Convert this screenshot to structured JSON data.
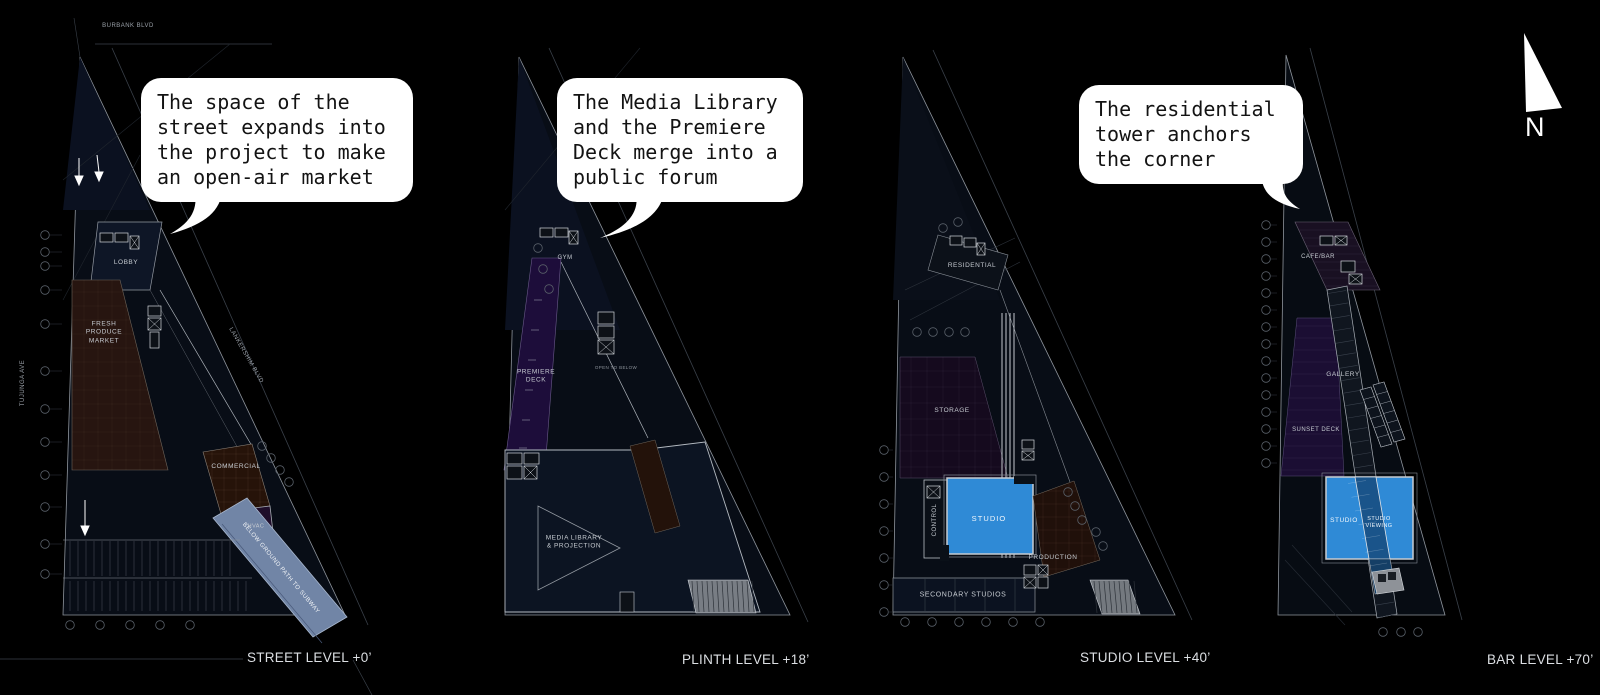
{
  "north_label": "N",
  "bubbles": {
    "b1": "The space of the\nstreet expands into\nthe project to make\nan open-air market",
    "b2": "The Media Library\nand the Premiere\nDeck merge into a\npublic forum",
    "b3": "The residential\ntower anchors\nthe corner"
  },
  "levels": {
    "street": "STREET LEVEL +0’",
    "plinth": "PLINTH LEVEL +18’",
    "studio": "STUDIO LEVEL +40’",
    "bar": "BAR LEVEL +70’"
  },
  "streets": {
    "burbank": "BURBANK BLVD",
    "tujunga": "TUJUNGA AVE",
    "lankershim": "LANKERSHIM BLVD"
  },
  "plan1": {
    "lobby": "LOBBY",
    "market": "FRESH\nPRODUCE\nMARKET",
    "commercial": "COMMERCIAL",
    "hvac": "HVAC",
    "subway": "BELOW GROUND PATH TO SUBWAY"
  },
  "plan2": {
    "gym": "GYM",
    "premiere_deck": "PREMIERE\nDECK",
    "open_to_below": "OPEN TO BELOW",
    "media_library": "MEDIA LIBRARY\n& PROJECTION"
  },
  "plan3": {
    "residential": "RESIDENTIAL",
    "storage": "STORAGE",
    "control": "CONTROL",
    "studio": "STUDIO",
    "production": "PRODUCTION",
    "secondary_studios": "SECONDARY STUDIOS"
  },
  "plan4": {
    "cafe_bar": "CAFE/BAR",
    "gallery": "GALLERY",
    "sunset_deck": "SUNSET DECK",
    "studio": "STUDIO",
    "studio_viewing": "STUDIO\nVIEWING"
  },
  "colors": {
    "studio_blue": "#2f8ad6",
    "market_brown": "#271510",
    "deck_purple": "#1d0d3a",
    "subway_blue": "#7185a6"
  }
}
